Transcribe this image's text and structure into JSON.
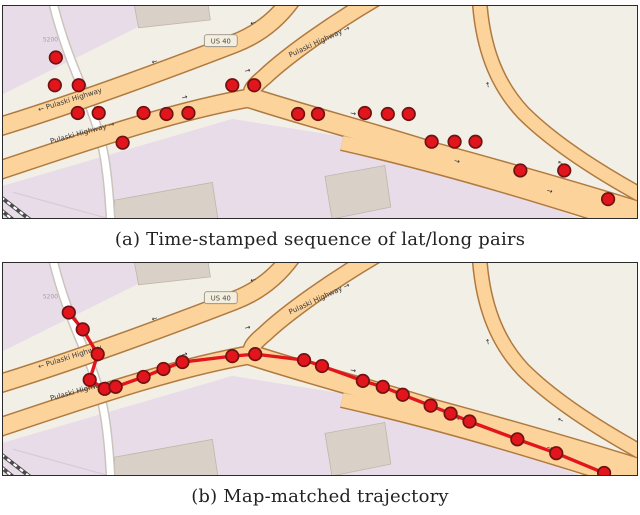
{
  "figure": {
    "caption_a": "(a) Time-stamped sequence of lat/long pairs",
    "caption_b": "(b) Map-matched trajectory"
  },
  "map_labels": {
    "highway_west": "← Pulaski Highway",
    "highway_east": "Pulaski Highway →",
    "highway_upper": "Pulaski Highway →",
    "route_shield": "US 40",
    "house_number": "5200"
  },
  "icons": {
    "arrow_right": "→",
    "arrow_left": "←"
  },
  "colors": {
    "point_fill": "#e2151c",
    "point_stroke": "#6f1212",
    "trajectory": "#e2151c",
    "road_fill": "#fbd39b",
    "road_casing": "#b07a3f",
    "residential_area": "#e9dce9",
    "base_area": "#f2efe7",
    "building": "#d9d0c8"
  },
  "panels": {
    "a": {
      "name": "raw-gps-points",
      "points": [
        [
          53,
          52
        ],
        [
          52,
          80
        ],
        [
          76,
          80
        ],
        [
          75,
          108
        ],
        [
          96,
          108
        ],
        [
          120,
          138
        ],
        [
          141,
          108
        ],
        [
          164,
          109
        ],
        [
          186,
          108
        ],
        [
          230,
          80
        ],
        [
          252,
          80
        ],
        [
          296,
          109
        ],
        [
          316,
          109
        ],
        [
          363,
          108
        ],
        [
          386,
          109
        ],
        [
          407,
          109
        ],
        [
          430,
          137
        ],
        [
          453,
          137
        ],
        [
          474,
          137
        ],
        [
          519,
          166
        ],
        [
          563,
          166
        ],
        [
          607,
          195
        ]
      ],
      "trajectory": false
    },
    "b": {
      "name": "map-matched-trajectory",
      "points": [
        [
          66,
          50
        ],
        [
          80,
          67
        ],
        [
          95,
          92
        ],
        [
          87,
          118
        ],
        [
          102,
          127
        ],
        [
          113,
          125
        ],
        [
          141,
          115
        ],
        [
          161,
          107
        ],
        [
          180,
          100
        ],
        [
          230,
          94
        ],
        [
          253,
          92
        ],
        [
          302,
          98
        ],
        [
          320,
          104
        ],
        [
          361,
          119
        ],
        [
          381,
          125
        ],
        [
          401,
          133
        ],
        [
          429,
          144
        ],
        [
          449,
          152
        ],
        [
          468,
          160
        ],
        [
          516,
          178
        ],
        [
          555,
          192
        ],
        [
          603,
          212
        ]
      ],
      "trajectory": true
    }
  }
}
